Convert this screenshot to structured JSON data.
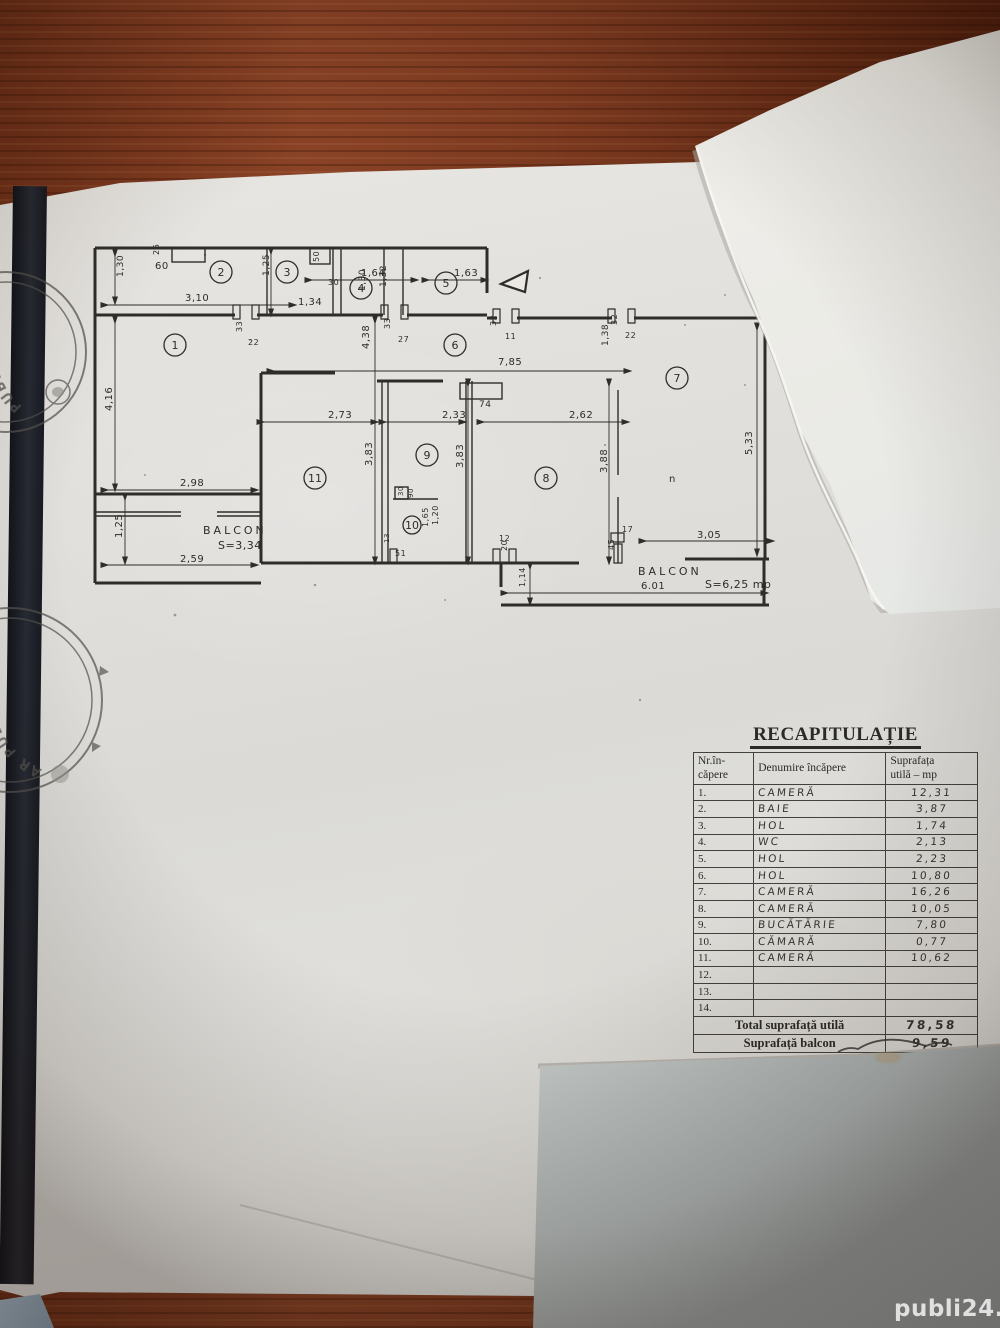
{
  "photo": {
    "watermark": "publi24.ro"
  },
  "stamps": {
    "stamp1_text": "PUBLI",
    "stamp2_text": "AR PUBLI"
  },
  "plan": {
    "rooms": [
      {
        "n": "1",
        "x": 90,
        "y": 110
      },
      {
        "n": "2",
        "x": 136,
        "y": 37
      },
      {
        "n": "3",
        "x": 202,
        "y": 37
      },
      {
        "n": "4",
        "x": 276,
        "y": 53
      },
      {
        "n": "5",
        "x": 361,
        "y": 48
      },
      {
        "n": "6",
        "x": 370,
        "y": 110
      },
      {
        "n": "7",
        "x": 592,
        "y": 143
      },
      {
        "n": "8",
        "x": 461,
        "y": 243
      },
      {
        "n": "9",
        "x": 342,
        "y": 220
      },
      {
        "n": "10",
        "x": 327,
        "y": 290,
        "r": 9
      },
      {
        "n": "11",
        "x": 230,
        "y": 243
      }
    ],
    "dims": [
      {
        "t": "60",
        "x": 70,
        "y": 34
      },
      {
        "t": "26",
        "x": 74,
        "y": 20,
        "r": -90,
        "s": 8
      },
      {
        "t": "3,10",
        "x": 100,
        "y": 66
      },
      {
        "t": "1,34",
        "x": 213,
        "y": 70
      },
      {
        "t": "22",
        "x": 163,
        "y": 110,
        "s": 8
      },
      {
        "t": "1,64",
        "x": 276,
        "y": 41
      },
      {
        "t": "1,63",
        "x": 369,
        "y": 41
      },
      {
        "t": "30",
        "x": 243,
        "y": 50,
        "s": 8
      },
      {
        "t": "27",
        "x": 313,
        "y": 107,
        "s": 8
      },
      {
        "t": "11",
        "x": 420,
        "y": 104,
        "s": 8
      },
      {
        "t": "22",
        "x": 540,
        "y": 103,
        "s": 8
      },
      {
        "t": "7,85",
        "x": 413,
        "y": 130
      },
      {
        "t": "74",
        "x": 394,
        "y": 172,
        "s": 9
      },
      {
        "t": "2,73",
        "x": 243,
        "y": 183
      },
      {
        "t": "2,33",
        "x": 357,
        "y": 183
      },
      {
        "t": "2,62",
        "x": 484,
        "y": 183
      },
      {
        "t": "2,98",
        "x": 95,
        "y": 251
      },
      {
        "t": "2,59",
        "x": 95,
        "y": 327
      },
      {
        "t": "3,05",
        "x": 612,
        "y": 303
      },
      {
        "t": "6.01",
        "x": 556,
        "y": 354
      },
      {
        "t": "12",
        "x": 414,
        "y": 306,
        "s": 8
      },
      {
        "t": "17",
        "x": 537,
        "y": 297,
        "s": 8
      },
      {
        "t": "51",
        "x": 310,
        "y": 321,
        "s": 8
      },
      {
        "t": "n",
        "x": 584,
        "y": 247,
        "s": 10
      },
      {
        "t": "1,30",
        "x": 38,
        "y": 42,
        "r": -90,
        "s": 9
      },
      {
        "t": "4,16",
        "x": 27,
        "y": 176,
        "r": -90
      },
      {
        "t": "1,25",
        "x": 37,
        "y": 303,
        "r": -90
      },
      {
        "t": "1,25",
        "x": 184,
        "y": 41,
        "r": -90,
        "s": 9
      },
      {
        "t": "50",
        "x": 234,
        "y": 27,
        "r": -90,
        "s": 8
      },
      {
        "t": "1,30",
        "x": 280,
        "y": 56,
        "r": -90,
        "s": 9
      },
      {
        "t": "1,32",
        "x": 301,
        "y": 52,
        "r": -90,
        "s": 9
      },
      {
        "t": "33",
        "x": 157,
        "y": 97,
        "r": -90,
        "s": 8
      },
      {
        "t": "33",
        "x": 305,
        "y": 94,
        "r": -90,
        "s": 8
      },
      {
        "t": "32",
        "x": 411,
        "y": 91,
        "r": -90,
        "s": 8
      },
      {
        "t": "32",
        "x": 532,
        "y": 90,
        "r": -90,
        "s": 8
      },
      {
        "t": "1,38",
        "x": 523,
        "y": 111,
        "r": -90,
        "s": 9
      },
      {
        "t": "4,38",
        "x": 284,
        "y": 114,
        "r": -90
      },
      {
        "t": "3,83",
        "x": 287,
        "y": 231,
        "r": -90
      },
      {
        "t": "3,83",
        "x": 378,
        "y": 233,
        "r": -90
      },
      {
        "t": "3,88",
        "x": 522,
        "y": 238,
        "r": -90
      },
      {
        "t": "5,33",
        "x": 667,
        "y": 220,
        "r": -90
      },
      {
        "t": "30",
        "x": 318,
        "y": 261,
        "r": -90,
        "s": 7
      },
      {
        "t": "90",
        "x": 328,
        "y": 263,
        "r": -90,
        "s": 7
      },
      {
        "t": "1,65",
        "x": 343,
        "y": 292,
        "r": -90,
        "s": 8
      },
      {
        "t": "1,20",
        "x": 353,
        "y": 290,
        "r": -90,
        "s": 8
      },
      {
        "t": "13",
        "x": 304,
        "y": 308,
        "r": -90,
        "s": 7
      },
      {
        "t": "20",
        "x": 422,
        "y": 316,
        "r": -90,
        "s": 8
      },
      {
        "t": "1,14",
        "x": 440,
        "y": 352,
        "r": -90,
        "s": 8
      },
      {
        "t": "45",
        "x": 529,
        "y": 315,
        "r": -90,
        "s": 8
      },
      {
        "t": "BALCON",
        "x": 118,
        "y": 299,
        "s": 11,
        "sp": 3
      },
      {
        "t": "S=3,34",
        "x": 133,
        "y": 314,
        "s": 11
      },
      {
        "t": "BALCON",
        "x": 553,
        "y": 340,
        "s": 11,
        "sp": 3
      },
      {
        "t": "S=6,25 mp",
        "x": 620,
        "y": 353,
        "s": 11
      }
    ]
  },
  "table": {
    "title": "RECAPITULAȚIE",
    "col1_header_line1": "Nr.în-",
    "col1_header_line2": "căpere",
    "col2_header": "Denumire încăpere",
    "col3_header_line1": "Suprafața",
    "col3_header_line2": "utilă – mp",
    "rows": [
      {
        "nr": "1.",
        "name": "CAMERĂ",
        "area": "12,31"
      },
      {
        "nr": "2.",
        "name": "BAIE",
        "area": "3,87"
      },
      {
        "nr": "3.",
        "name": "HOL",
        "area": "1,74"
      },
      {
        "nr": "4.",
        "name": "WC",
        "area": "2,13"
      },
      {
        "nr": "5.",
        "name": "HOL",
        "area": "2,23"
      },
      {
        "nr": "6.",
        "name": "HOL",
        "area": "10,80"
      },
      {
        "nr": "7.",
        "name": "CAMERĂ",
        "area": "16,26"
      },
      {
        "nr": "8.",
        "name": "CAMERĂ",
        "area": "10,05"
      },
      {
        "nr": "9.",
        "name": "BUCĂTĂRIE",
        "area": "7,80"
      },
      {
        "nr": "10.",
        "name": "CĂMARĂ",
        "area": "0,77"
      },
      {
        "nr": "11.",
        "name": "CAMERĂ",
        "area": "10,62"
      },
      {
        "nr": "12.",
        "name": "",
        "area": ""
      },
      {
        "nr": "13.",
        "name": "",
        "area": ""
      },
      {
        "nr": "14.",
        "name": "",
        "area": ""
      }
    ],
    "total_label": "Total suprafață utilă",
    "total_value": "78,58",
    "balcony_label": "Suprafață balcon",
    "balcony_value": "9,59"
  }
}
